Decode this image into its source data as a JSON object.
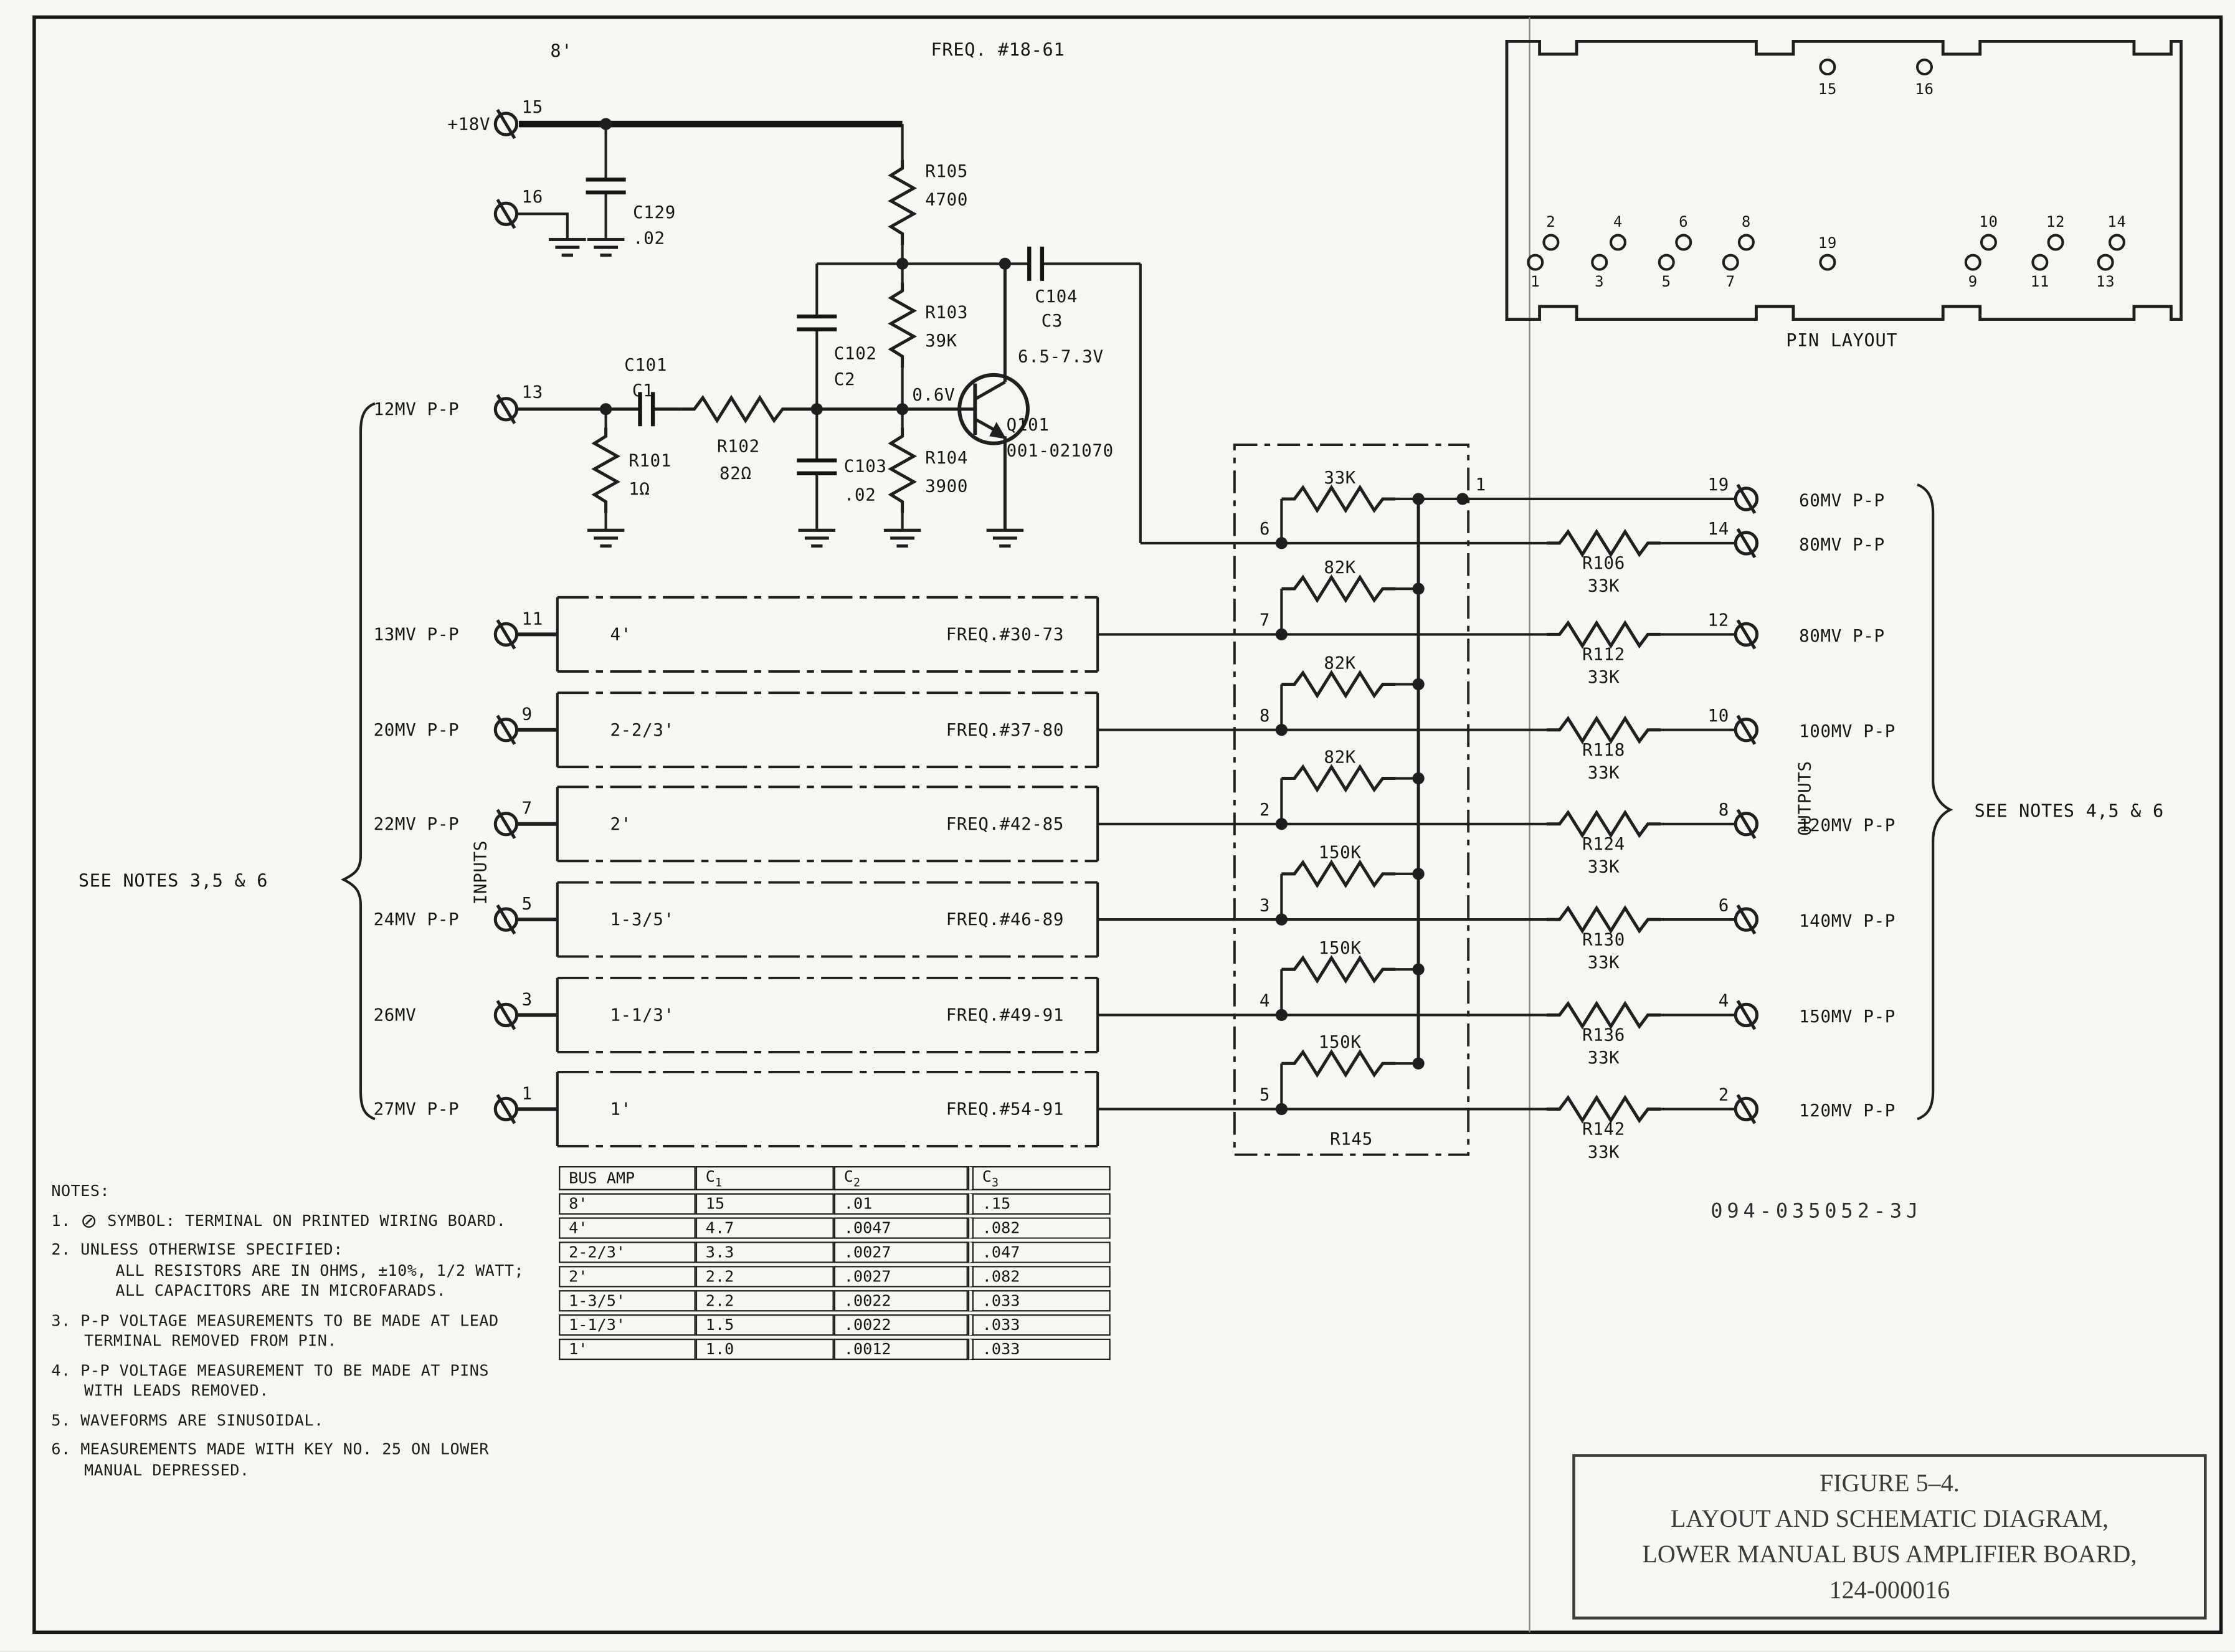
{
  "colors": {
    "ink": "#1c1c1c",
    "paper": "#f7f6f2"
  },
  "doc_number": "094-035052-3J",
  "title_block": {
    "line1": "FIGURE 5–4.",
    "line2": "LAYOUT AND SCHEMATIC DIAGRAM,",
    "line3": "LOWER MANUAL BUS AMPLIFIER BOARD,",
    "line4": "124-000016"
  },
  "amp": {
    "bus": "8'",
    "freq": "FREQ. #18-61",
    "supply": "+18V",
    "pins": {
      "p15": "15",
      "p16": "16",
      "p13": "13"
    },
    "input_mv": "12MV P-P",
    "c129": {
      "n": "C129",
      "v": ".02"
    },
    "r105": {
      "n": "R105",
      "v": "4700"
    },
    "c104": {
      "n": "C104",
      "v": "C3"
    },
    "c102": {
      "n": "C102",
      "v": "C2"
    },
    "r103": {
      "n": "R103",
      "v": "39K"
    },
    "c101": {
      "n": "C101",
      "v": "C1"
    },
    "r102": {
      "n": "R102",
      "v": "82Ω"
    },
    "r101": {
      "n": "R101",
      "v": "1Ω"
    },
    "c103": {
      "n": "C103",
      "v": ".02"
    },
    "r104": {
      "n": "R104",
      "v": "3900"
    },
    "q101": {
      "n": "Q101",
      "v": "001-021070",
      "vce": "6.5-7.3V",
      "vbe": "0.6V"
    }
  },
  "inputs": {
    "label": "INPUTS",
    "brace_note": "SEE NOTES 3,5 & 6",
    "rows": [
      {
        "mv": "13MV P-P",
        "pin": "11",
        "feet": "4'",
        "freq": "FREQ.#30-73"
      },
      {
        "mv": "20MV P-P",
        "pin": "9",
        "feet": "2-2/3'",
        "freq": "FREQ.#37-80"
      },
      {
        "mv": "22MV P-P",
        "pin": "7",
        "feet": "2'",
        "freq": "FREQ.#42-85"
      },
      {
        "mv": "24MV P-P",
        "pin": "5",
        "feet": "1-3/5'",
        "freq": "FREQ.#46-89"
      },
      {
        "mv": "26MV",
        "pin": "3",
        "feet": "1-1/3'",
        "freq": "FREQ.#49-91"
      },
      {
        "mv": "27MV P-P",
        "pin": "1",
        "feet": "1'",
        "freq": "FREQ.#54-91"
      }
    ]
  },
  "network": {
    "name": "R145",
    "node1": "1",
    "rows": [
      {
        "node": "6",
        "r": "33K"
      },
      {
        "node": "7",
        "r": "82K"
      },
      {
        "node": "8",
        "r": "82K"
      },
      {
        "node": "2",
        "r": "82K"
      },
      {
        "node": "3",
        "r": "150K"
      },
      {
        "node": "4",
        "r": "150K"
      },
      {
        "node": "5",
        "r": "150K"
      }
    ]
  },
  "outputs": {
    "label": "OUTPUTS",
    "brace_note": "SEE NOTES 4,5 & 6",
    "rows": [
      {
        "pin": "19",
        "mv": "60MV P-P",
        "rname": "",
        "rval": ""
      },
      {
        "pin": "14",
        "mv": "80MV P-P",
        "rname": "R106",
        "rval": "33K"
      },
      {
        "pin": "12",
        "mv": "80MV P-P",
        "rname": "R112",
        "rval": "33K"
      },
      {
        "pin": "10",
        "mv": "100MV P-P",
        "rname": "R118",
        "rval": "33K"
      },
      {
        "pin": "8",
        "mv": "120MV P-P",
        "rname": "R124",
        "rval": "33K"
      },
      {
        "pin": "6",
        "mv": "140MV P-P",
        "rname": "R130",
        "rval": "33K"
      },
      {
        "pin": "4",
        "mv": "150MV P-P",
        "rname": "R136",
        "rval": "33K"
      },
      {
        "pin": "2",
        "mv": "120MV P-P",
        "rname": "R142",
        "rval": "33K"
      }
    ]
  },
  "pin_layout": {
    "caption": "PIN LAYOUT",
    "top": [
      "15",
      "16"
    ],
    "left_upper": [
      "2",
      "4",
      "6",
      "8"
    ],
    "left_lower": [
      "1",
      "3",
      "5",
      "7"
    ],
    "center": "19",
    "right_upper": [
      "10",
      "12",
      "14"
    ],
    "right_lower": [
      "9",
      "11",
      "13"
    ]
  },
  "notes": {
    "heading": "NOTES:",
    "n1": {
      "pre": "1.",
      "sym": "⊘",
      "text": "SYMBOL: TERMINAL ON PRINTED WIRING BOARD."
    },
    "n2": {
      "a": "2. UNLESS OTHERWISE SPECIFIED:",
      "b": "ALL RESISTORS ARE IN OHMS, ±10%, 1/2 WATT;",
      "c": "ALL CAPACITORS ARE IN MICROFARADS."
    },
    "n3": {
      "a": "3. P-P VOLTAGE MEASUREMENTS TO BE MADE AT LEAD",
      "b": "TERMINAL REMOVED FROM PIN."
    },
    "n4": {
      "a": "4. P-P VOLTAGE MEASUREMENT TO BE MADE AT PINS",
      "b": "WITH LEADS REMOVED."
    },
    "n5": "5. WAVEFORMS ARE SINUSOIDAL.",
    "n6": {
      "a": "6. MEASUREMENTS MADE WITH KEY NO. 25 ON LOWER",
      "b": "MANUAL DEPRESSED."
    }
  },
  "cap_table": {
    "headers": {
      "c0": "BUS AMP",
      "c1": {
        "b": "C",
        "s": "1"
      },
      "c2": {
        "b": "C",
        "s": "2"
      },
      "c3": {
        "b": "C",
        "s": "3"
      }
    },
    "rows": [
      [
        "8'",
        "15",
        ".01",
        ".15"
      ],
      [
        "4'",
        "4.7",
        ".0047",
        ".082"
      ],
      [
        "2-2/3'",
        "3.3",
        ".0027",
        ".047"
      ],
      [
        "2'",
        "2.2",
        ".0027",
        ".082"
      ],
      [
        "1-3/5'",
        "2.2",
        ".0022",
        ".033"
      ],
      [
        "1-1/3'",
        "1.5",
        ".0022",
        ".033"
      ],
      [
        "1'",
        "1.0",
        ".0012",
        ".033"
      ]
    ]
  }
}
